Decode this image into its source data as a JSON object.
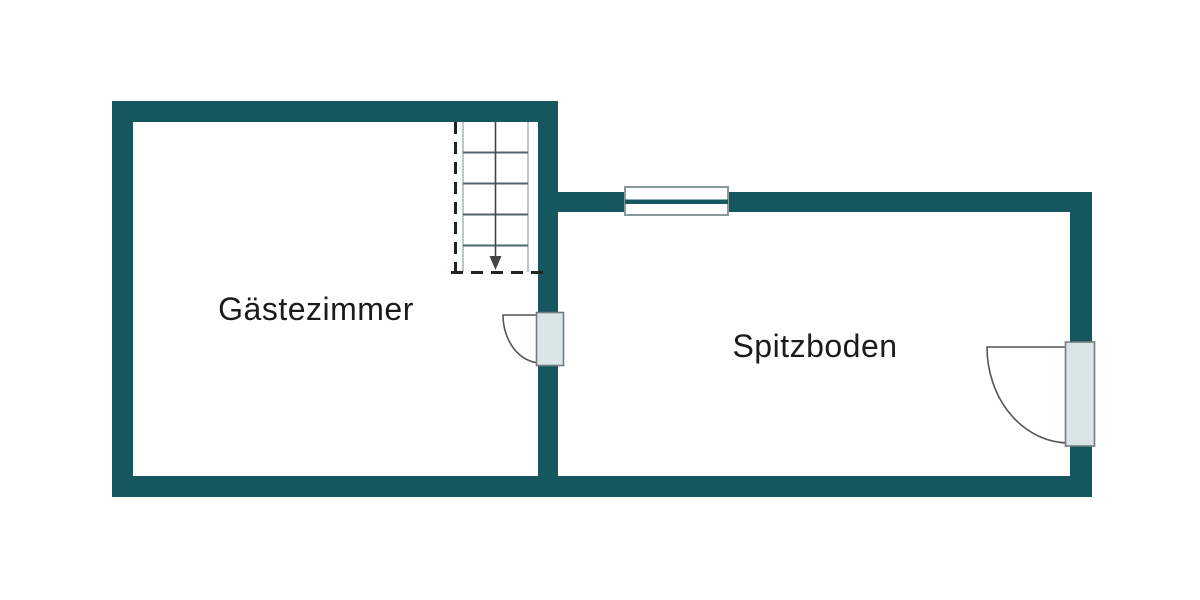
{
  "floorplan": {
    "rooms": [
      {
        "name": "Gästezimmer"
      },
      {
        "name": "Spitzboden"
      }
    ],
    "colors": {
      "wall": "#16565f",
      "door_leaf": "#d9e5e7",
      "door_outline": "#6f7d80",
      "swing_line": "#555555",
      "stair_step": "#51666a",
      "stair_dash": "#232323",
      "window_frame": "#8a9a9c",
      "label_text": "#1b1b1b",
      "background": "#ffffff"
    },
    "features": {
      "staircase": "stairs-down-icon",
      "interior_door": "door-swing-icon",
      "exterior_door": "door-swing-icon",
      "window": "window-icon"
    }
  }
}
